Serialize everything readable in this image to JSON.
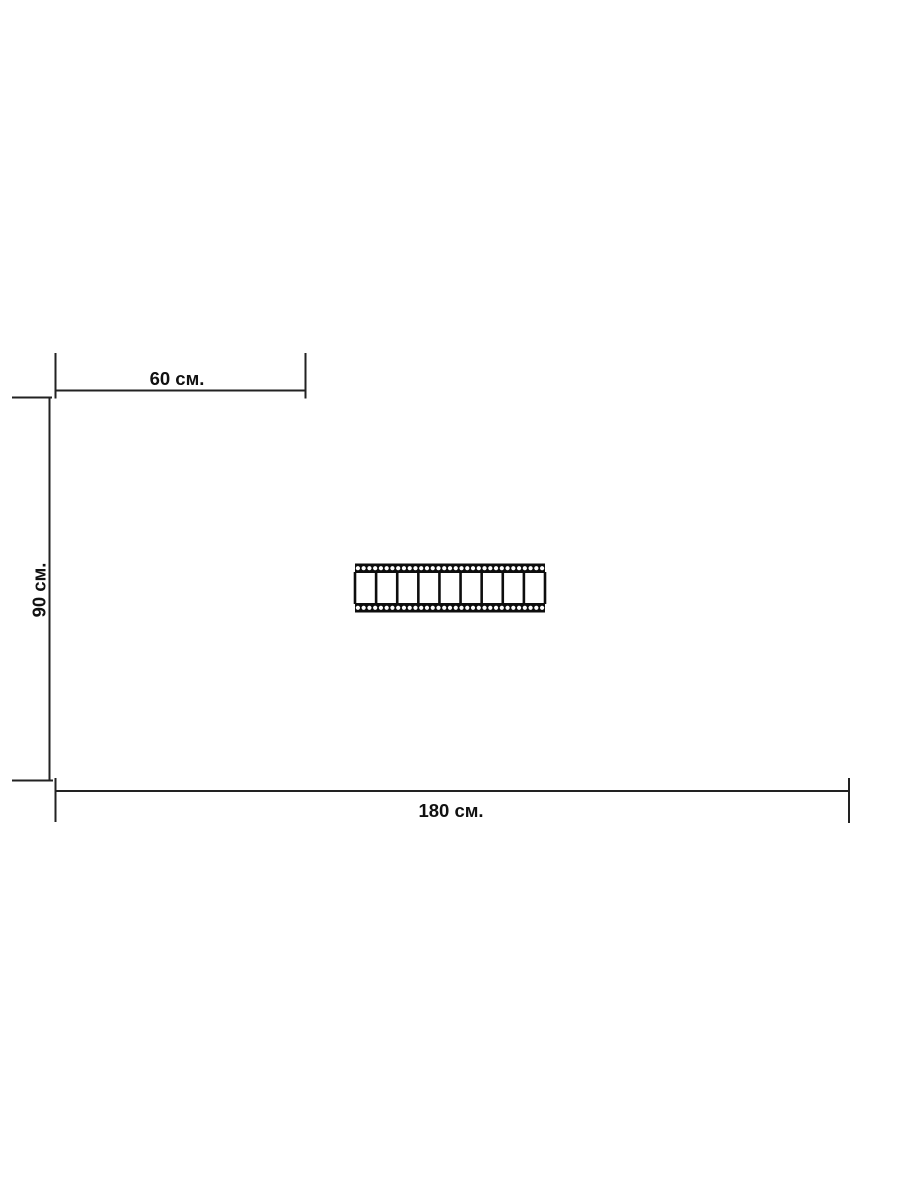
{
  "page": {
    "background": "#ffffff",
    "ink_color": "#222222",
    "text_color": "#111111"
  },
  "diagram": {
    "type": "product-dimensions-drawing",
    "labels": {
      "top_width": "60 см.",
      "side_height": "90 см.",
      "bottom_width": "180 см."
    },
    "values": {
      "top_width_cm": 60,
      "side_height_cm": 90,
      "bottom_width_cm": 180
    },
    "filmstrip": {
      "frames": 9,
      "perforations_per_row": 33,
      "perforation_rows": 2,
      "fill_color": "#0d0d0d",
      "frame_fill": "#ffffff"
    }
  }
}
